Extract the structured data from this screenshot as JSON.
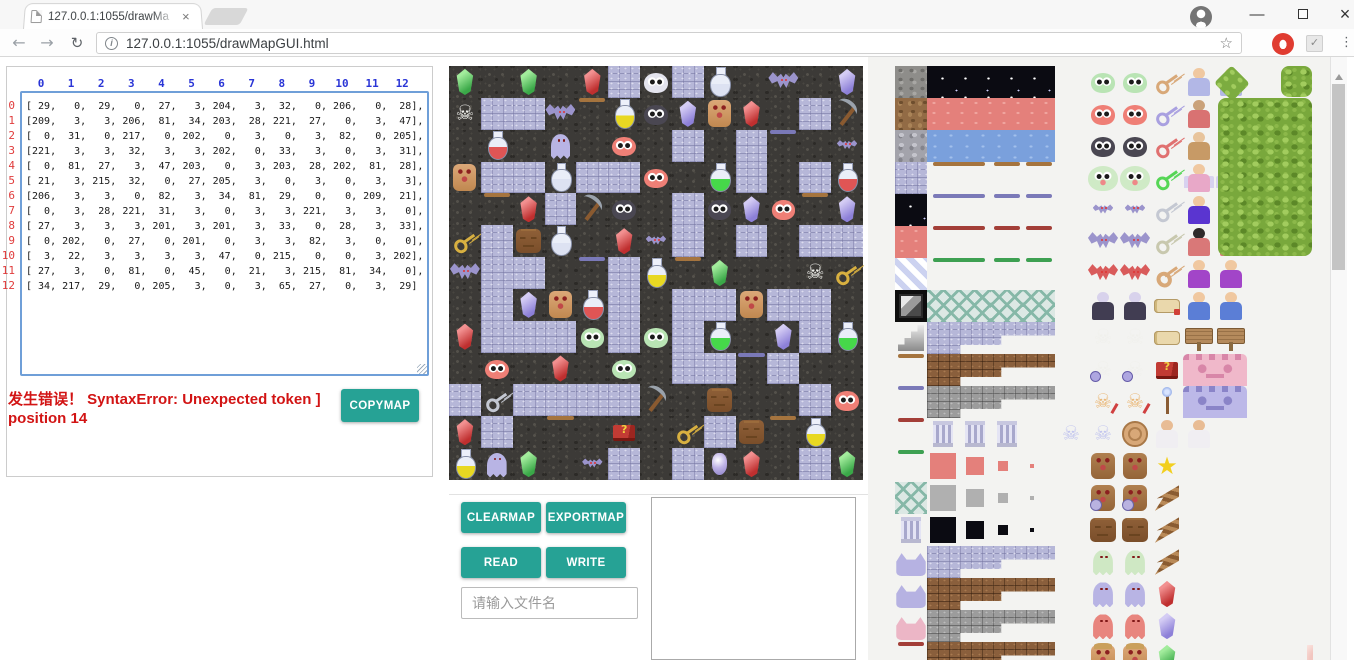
{
  "browser": {
    "tab_title": "127.0.0.1:1055/drawMa",
    "tab_close": "×",
    "url": "127.0.0.1:1055/drawMapGUI.html",
    "icons": {
      "back": "←",
      "forward": "→",
      "reload": "↻",
      "info": "i",
      "bookmark_star": "☆",
      "extension_check": "✓",
      "menu_dots": "⋮",
      "minimize": "—",
      "close": "×"
    }
  },
  "left": {
    "col_headers": [
      "0",
      "1",
      "2",
      "3",
      "4",
      "5",
      "6",
      "7",
      "8",
      "9",
      "10",
      "11",
      "12"
    ],
    "row_headers": [
      "0",
      "1",
      "2",
      "3",
      "4",
      "5",
      "6",
      "7",
      "8",
      "9",
      "10",
      "11",
      "12"
    ],
    "error_line1": "发生错误！ SyntaxError: Unexpected token ]",
    "error_line2": "position 14",
    "copymap": "COPYMAP"
  },
  "controls": {
    "clearmap": "CLEARMAP",
    "exportmap": "EXPORTMAP",
    "read": "READ",
    "write": "WRITE",
    "file_placeholder": "请输入文件名"
  },
  "colors": {
    "accent_teal": "#26a295",
    "error_red": "#d21414",
    "header_blue": "#2a35d6",
    "rownum_red": "#e03c3c"
  },
  "map": {
    "matrix": [
      [
        29,
        0,
        29,
        0,
        27,
        3,
        204,
        3,
        32,
        0,
        206,
        0,
        28
      ],
      [
        209,
        3,
        3,
        206,
        81,
        34,
        203,
        28,
        221,
        27,
        0,
        3,
        47
      ],
      [
        0,
        31,
        0,
        217,
        0,
        202,
        0,
        3,
        0,
        3,
        82,
        0,
        205
      ],
      [
        221,
        3,
        3,
        32,
        3,
        3,
        202,
        0,
        33,
        3,
        0,
        3,
        31
      ],
      [
        0,
        81,
        27,
        3,
        47,
        203,
        0,
        3,
        203,
        28,
        202,
        81,
        28
      ],
      [
        21,
        3,
        215,
        32,
        0,
        27,
        205,
        3,
        0,
        3,
        0,
        3,
        3
      ],
      [
        206,
        3,
        3,
        0,
        82,
        3,
        34,
        81,
        29,
        0,
        0,
        209,
        21
      ],
      [
        0,
        3,
        28,
        221,
        31,
        3,
        0,
        3,
        3,
        221,
        3,
        3,
        0
      ],
      [
        27,
        3,
        3,
        3,
        201,
        3,
        201,
        3,
        33,
        0,
        28,
        3,
        33
      ],
      [
        0,
        202,
        0,
        27,
        0,
        201,
        0,
        3,
        3,
        82,
        3,
        0,
        0
      ],
      [
        3,
        22,
        3,
        3,
        3,
        3,
        47,
        0,
        215,
        0,
        0,
        3,
        202
      ],
      [
        27,
        3,
        0,
        81,
        0,
        45,
        0,
        21,
        3,
        215,
        81,
        34,
        0
      ],
      [
        34,
        217,
        29,
        0,
        205,
        3,
        0,
        3,
        65,
        27,
        0,
        3,
        29
      ]
    ],
    "legend": {
      "0": "floor",
      "3": "path",
      "21": "key-gold",
      "22": "key-silver",
      "27": "gem-red",
      "28": "gem-purple",
      "29": "gem-green",
      "31": "potion-red",
      "32": "potion-white",
      "33": "potion-green",
      "34": "potion-yellow",
      "45": "book-red",
      "47": "pickaxe",
      "65": "orb-purple",
      "81": "door-tan",
      "82": "door-purple",
      "201": "slime-green",
      "202": "slime-red",
      "203": "slime-black",
      "204": "slime-white",
      "205": "bat-small",
      "206": "bat-big",
      "209": "skeleton",
      "215": "stone-face",
      "217": "ghost-purple",
      "221": "golem-tan"
    }
  },
  "tileset": {
    "rows": [
      [
        "rock",
        "night:4",
        "gap",
        "slime-green",
        "slime-green",
        "key-tan",
        "pers-oldman",
        "pers-oldman"
      ],
      [
        "dirt",
        "band-red:4",
        "gap",
        "slime-red",
        "slime-red",
        "key-purple",
        "pers-dwarf",
        "pers-dwarf"
      ],
      [
        "stone",
        "band-blue:4",
        "gap",
        "slime-black",
        "slime-black",
        "key-red",
        "pers-barb",
        "pers-barb"
      ],
      [
        "brick",
        "door-tan:2",
        "door-tan",
        "door-tan",
        "gap",
        "slime-big",
        "slime-big",
        "key-green",
        "pers-fairy",
        "pers-fairy"
      ],
      [
        "night",
        "door-purple:2",
        "door-purple",
        "door-purple",
        "gap",
        "bat-small",
        "bat-small",
        "key-silver",
        "pers-wizard",
        "pers-wizard"
      ],
      [
        "redtile",
        "door-red:2",
        "door-red",
        "door-red",
        "gap",
        "bat-big",
        "bat-big",
        "key-ornate",
        "pers-priest",
        "pers-priest"
      ],
      [
        "stripe",
        "door-green:2",
        "door-green",
        "door-green",
        "gap",
        "bat-red",
        "bat-red",
        "key-axe",
        "pers-king",
        "pers-king"
      ],
      [
        "gradbox",
        "lattice:2",
        "lattice",
        "lattice",
        "gap",
        "pers-vampire",
        "pers-vampire",
        "scroll-ribbon",
        "pers-boy",
        "pers-boy"
      ],
      [
        "stairs",
        "step-stone:4",
        "gap",
        "skeleton",
        "skeleton",
        "scroll",
        "signpost",
        "signpost"
      ],
      [
        "door-tan",
        "step-brown:4",
        "gap",
        "skel-warrior",
        "skel-warrior",
        "book-red",
        "wall-pink:2"
      ],
      [
        "door-purple",
        "step-gray:4",
        "gap",
        "skel-orange",
        "skel-orange",
        "staff",
        "wall-purple:2"
      ],
      [
        "door-red",
        "pillar",
        "pillar",
        "pillar",
        "gap",
        "skel-blue",
        "skel-blue",
        "medallion",
        "pers-princess",
        "pers-princess"
      ],
      [
        "door-green",
        "shrink-red:4",
        "gap",
        "golem-brown",
        "golem-brown",
        "star-yellow"
      ],
      [
        "lattice",
        "shrink-gray:4",
        "gap",
        "golem-warrior",
        "golem-warrior",
        "wing-staff"
      ],
      [
        "pillar",
        "shrink-night:4",
        "gap",
        "stone-face",
        "stone-face",
        "wing-staff"
      ],
      [
        "gargoyle",
        "step-stone:4",
        "gap",
        "ghost-green",
        "ghost-green",
        "wing-staff"
      ],
      [
        "gargoyle",
        "step-brown:4",
        "gap",
        "ghost-purple",
        "ghost-purple",
        "gem-red"
      ],
      [
        "gargoyle-pink",
        "step-gray:4",
        "gap",
        "ghost-red",
        "ghost-red",
        "gem-purple"
      ],
      [
        "door-red",
        "step-brown:4",
        "gap",
        "golem-hat",
        "golem-hat",
        "gem-green"
      ]
    ],
    "extras": [
      {
        "kind": "bush-diamond",
        "x": 322,
        "y": 3,
        "w": 30,
        "h": 28
      },
      {
        "kind": "tree-square",
        "x": 386,
        "y": 0,
        "w": 31,
        "h": 31
      },
      {
        "kind": "tree-large",
        "x": 323,
        "y": 32,
        "w": 94,
        "h": 158
      },
      {
        "kind": "pink-blob",
        "x": 412,
        "y": 579,
        "w": 46,
        "h": 15
      }
    ]
  }
}
